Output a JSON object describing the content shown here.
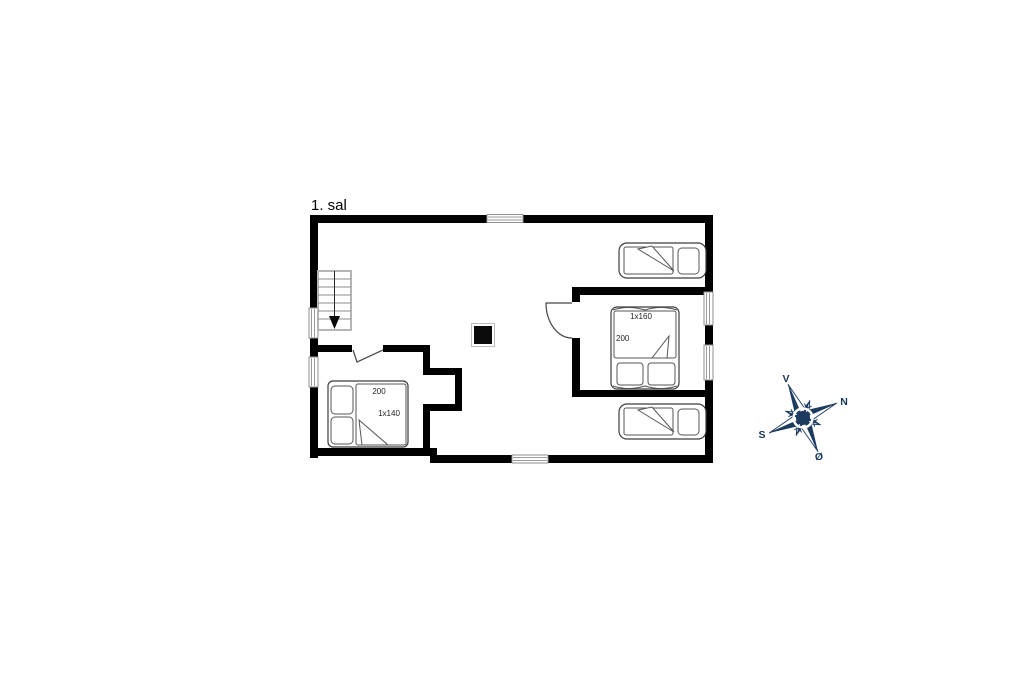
{
  "title": "1. sal",
  "colors": {
    "wall": "#000000",
    "background": "#ffffff",
    "compass": "#1c3b5e",
    "bed_outline": "#3c3c3c"
  },
  "beds": {
    "left_double": {
      "length_label": "200",
      "size_label": "1x140"
    },
    "right_double": {
      "size_label": "1x160",
      "length_label": "200"
    }
  },
  "compass": {
    "top": "V",
    "right": "N",
    "left": "S",
    "bottom": "Ø"
  },
  "icons": {
    "compass": "compass-rose",
    "stairs": "staircase-with-down-arrow",
    "chimney": "chimney-block",
    "doors": "door-swing-symbol",
    "windows": "window-symbol"
  }
}
